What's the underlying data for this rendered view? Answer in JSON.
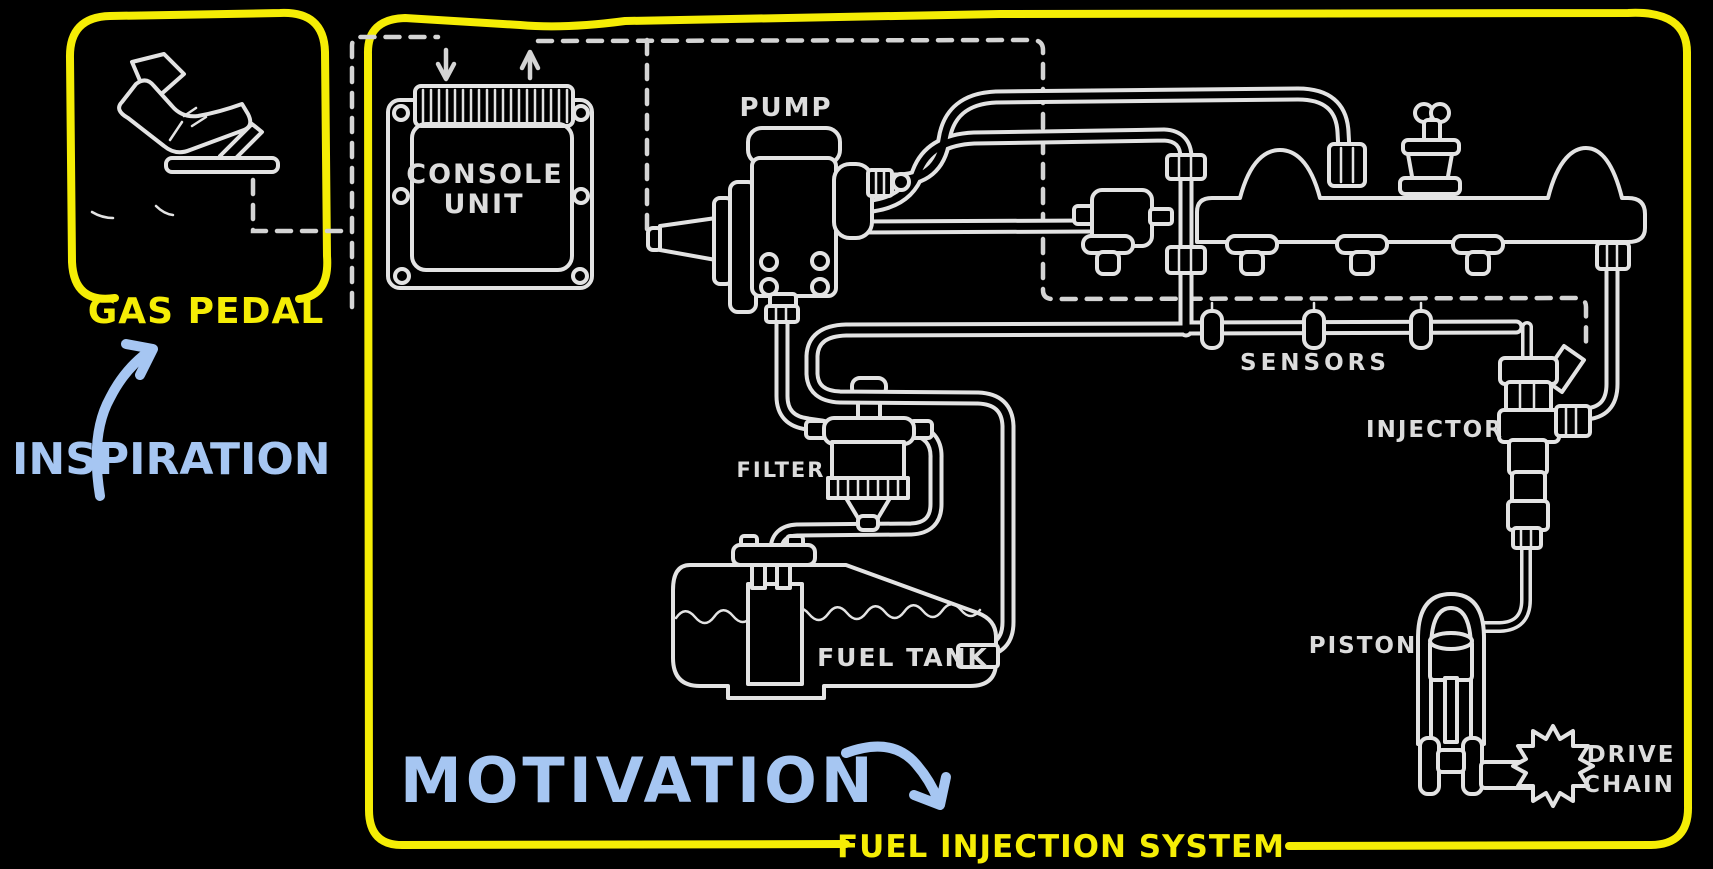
{
  "colors": {
    "background": "#000000",
    "sketch_stroke": "#e3e3e3",
    "wire_dash": "#d4d4d4",
    "accent_yellow": "#f5ed05",
    "accent_blue": "#a6c6f2"
  },
  "gas_pedal_panel": {
    "label": "GAS PEDAL",
    "annotation": "INSPIRATION"
  },
  "fuel_system_panel": {
    "label": "FUEL INJECTION SYSTEM",
    "annotation": "MOTIVATION"
  },
  "components": {
    "console_unit": {
      "label_line1": "CONSOLE",
      "label_line2": "UNIT"
    },
    "pump": {
      "label": "PUMP"
    },
    "sensors": {
      "label": "SENSORS"
    },
    "injector": {
      "label": "INJECTOR"
    },
    "filter": {
      "label": "FILTER"
    },
    "fuel_tank": {
      "label": "FUEL TANK"
    },
    "piston": {
      "label": "PISTON"
    },
    "drive_chain": {
      "label_line1": "DRIVE",
      "label_line2": "CHAIN"
    }
  }
}
